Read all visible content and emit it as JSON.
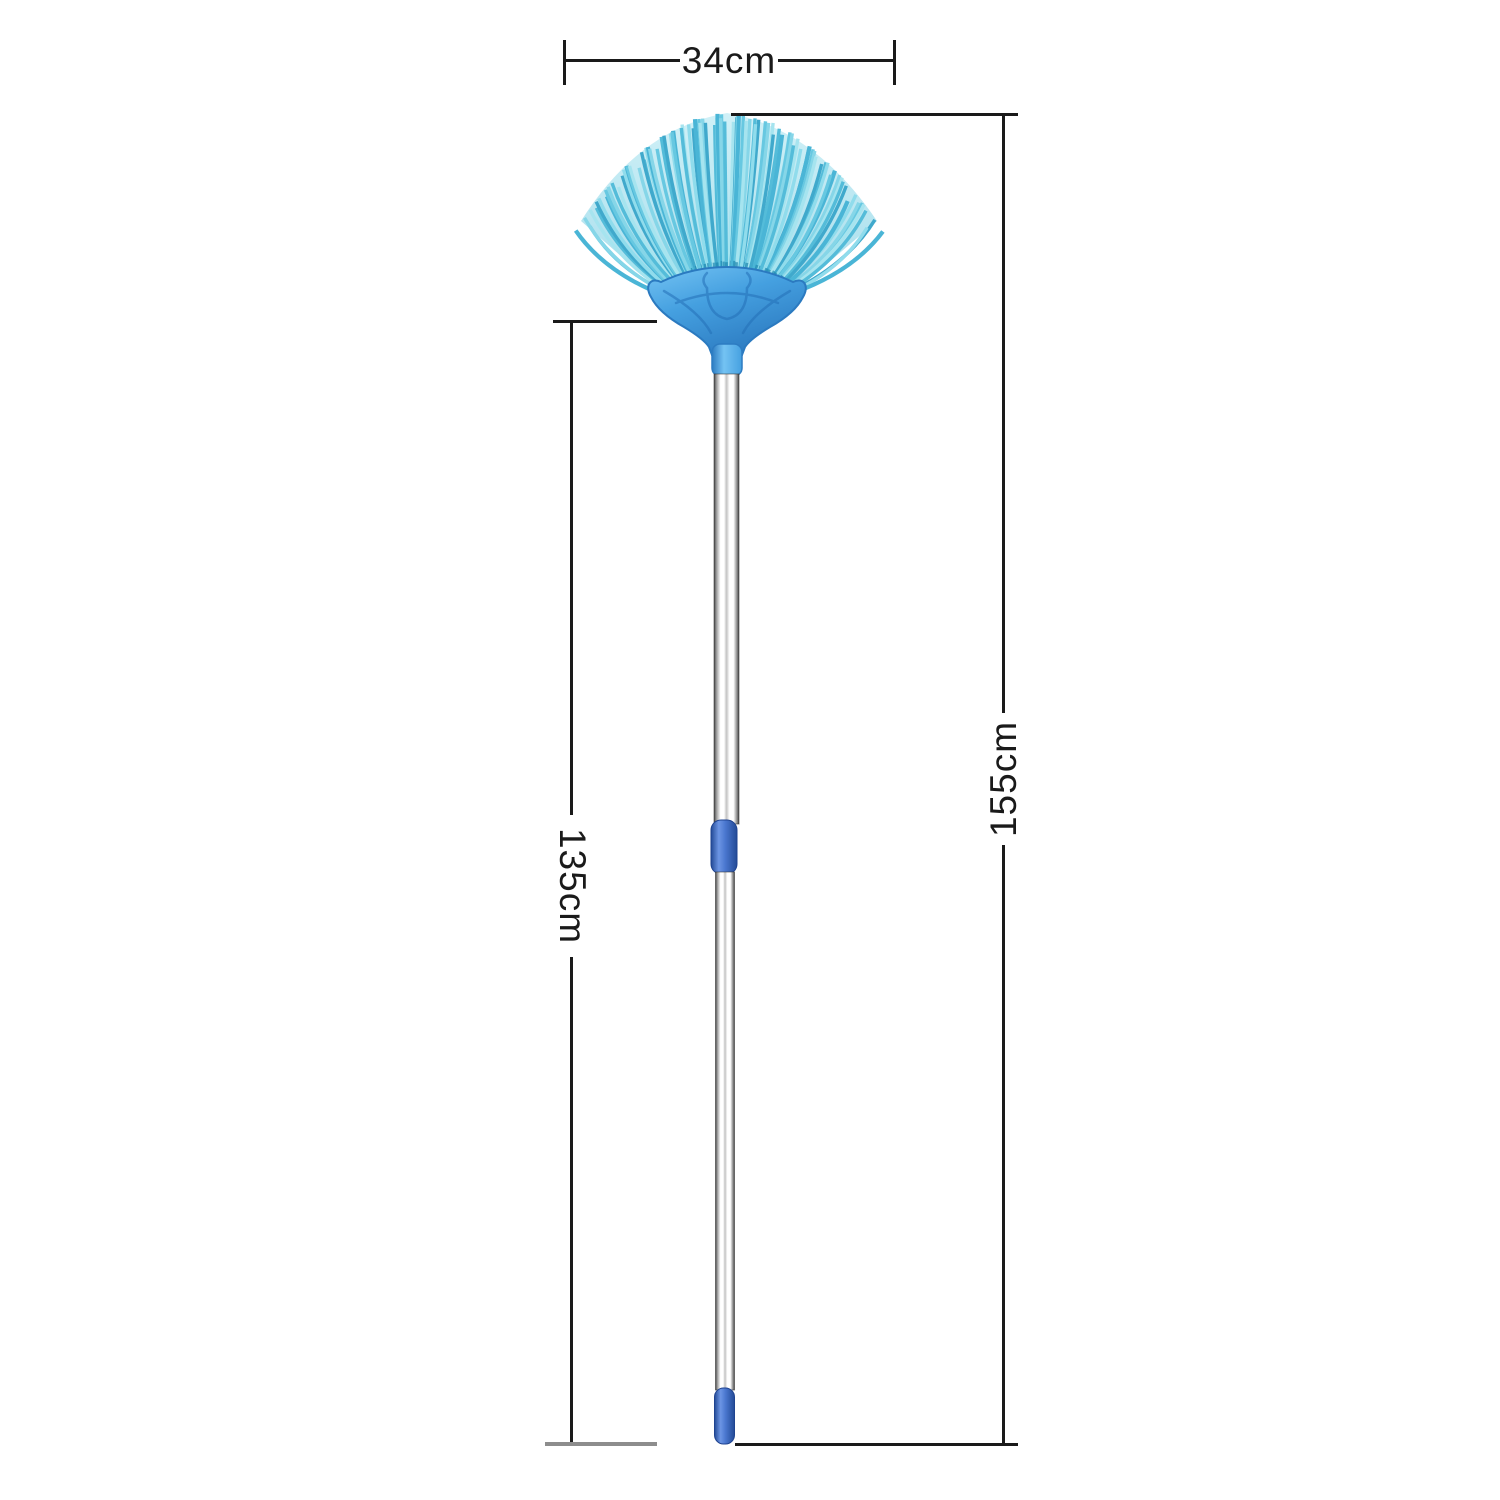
{
  "labels": {
    "width": "34cm",
    "handle": "135cm",
    "total": "155cm"
  },
  "colors": {
    "background": "#ffffff",
    "dimension_line": "#1a1a1a",
    "dimension_line_gray": "#8d8d8d",
    "label_color": "#1a1a1a",
    "bristle_palette": [
      "#4ab5d6",
      "#67c8e1",
      "#86d6e8",
      "#a6e4ef",
      "#54bcd9",
      "#40a9cc",
      "#90dcec"
    ],
    "bristle_root": "#1f88b0",
    "fan_fill_top": "#aae5f1",
    "fan_fill_bottom": "#5fc2dc",
    "holder_light": "#74c3f3",
    "holder_mid": "#45a0e0",
    "holder_dark": "#2d7cc2",
    "holder_outline": "#2b7ac0",
    "emboss": "#2470b8",
    "pole_edge": "#474747",
    "pole_mid": "#9c9c9c",
    "pole_light": "#ffffff",
    "pole_seam": "#c2c2c2",
    "collar_dark": "#234a96",
    "collar_mid": "#4a77cf",
    "collar_light": "#6c95e4",
    "collar_outline": "#1f4390"
  }
}
